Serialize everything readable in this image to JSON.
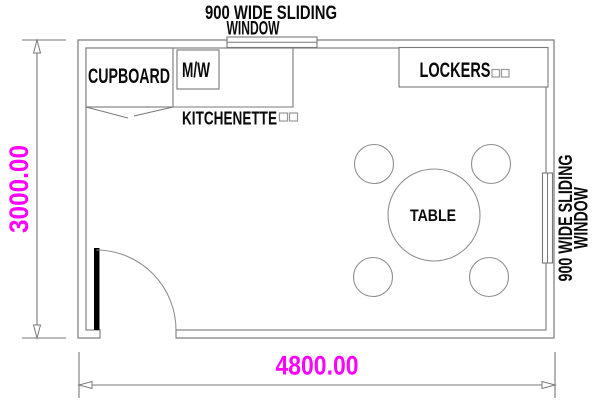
{
  "title": "Room floor plan",
  "colors": {
    "background": "#ffffff",
    "line": "#787878",
    "furniture_line": "#8f8f8f",
    "text": "#0a0a0a",
    "dimension_text": "#FF00FF",
    "door_leaf": "#000000"
  },
  "dimensions": {
    "width": "4800.00",
    "height": "3000.00"
  },
  "windows": {
    "top": {
      "line1": "900 WIDE SLIDING",
      "line2": "WINDOW"
    },
    "right": {
      "line1": "900 WIDE SLIDING",
      "line2": "WINDOW"
    }
  },
  "labels": {
    "cupboard": "CUPBOARD",
    "microwave": "M/W",
    "kitchenette": "KITCHENETTE",
    "lockers": "LOCKERS",
    "table": "TABLE"
  }
}
